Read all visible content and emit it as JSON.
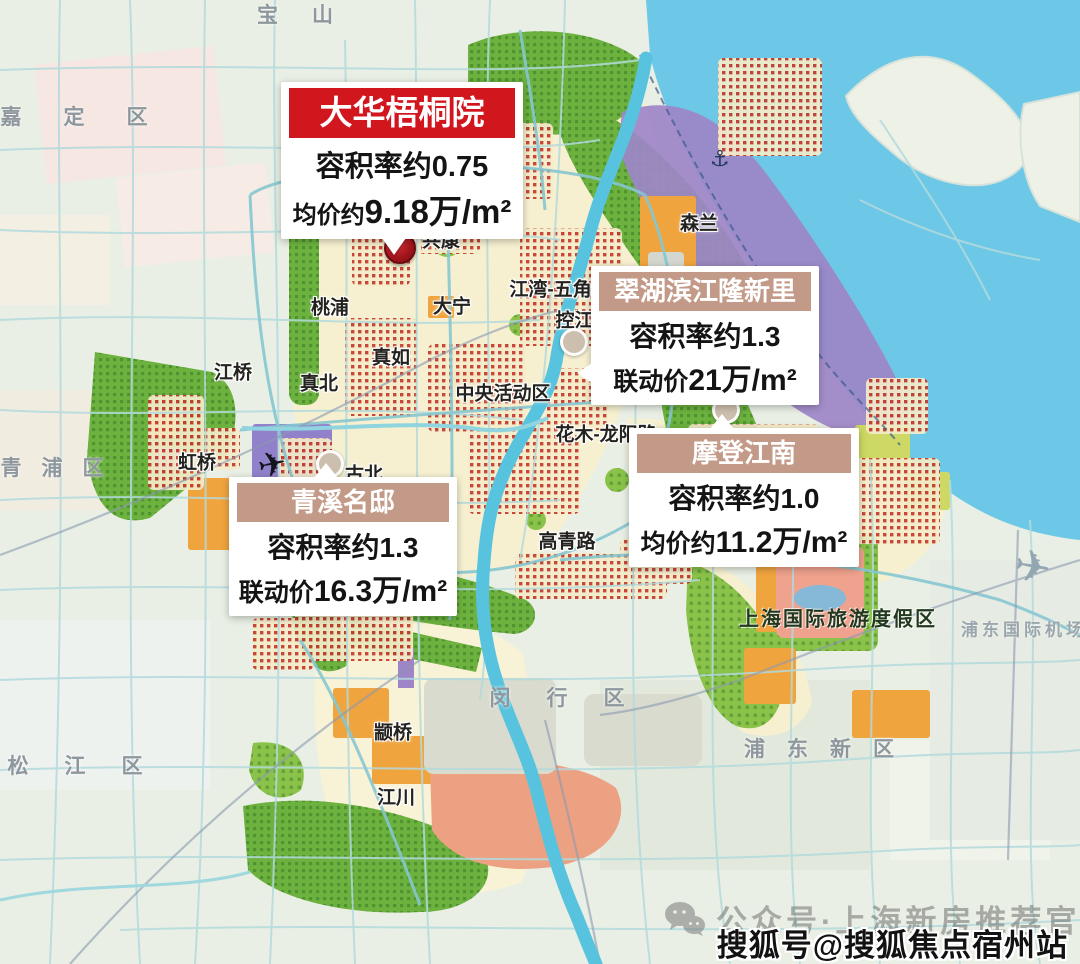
{
  "callouts": [
    {
      "name": "大华梧桐院",
      "line1": "容积率约0.75",
      "line2_label": "均价约",
      "line2_value": "9.18万/m²"
    },
    {
      "name": "翠湖滨江隆新里",
      "line1": "容积率约1.3",
      "line2_label": "联动价",
      "line2_value": "21万/m²"
    },
    {
      "name": "摩登江南",
      "line1": "容积率约1.0",
      "line2_label": "均价约",
      "line2_value": "11.2万/m²"
    },
    {
      "name": "青溪名邸",
      "line1": "容积率约1.3",
      "line2_label": "联动价",
      "line2_value": "16.3万/m²"
    }
  ],
  "watermarks": {
    "wechat": "公众号·上海新房推荐官",
    "sohu": "搜狐号@搜狐焦点宿州站"
  },
  "map_labels": {
    "districts": [
      {
        "text": "宝山",
        "x": 312,
        "y": 14,
        "ls": 34
      },
      {
        "text": "嘉定区",
        "x": 95,
        "y": 116,
        "ls": 42
      },
      {
        "text": "青浦区",
        "x": 62,
        "y": 467,
        "ls": 20
      },
      {
        "text": "松江区",
        "x": 93,
        "y": 765,
        "ls": 36
      },
      {
        "text": "闵行区",
        "x": 575,
        "y": 697,
        "ls": 36
      },
      {
        "text": "浦东新区",
        "x": 830,
        "y": 748,
        "ls": 22
      }
    ],
    "places": [
      {
        "text": "共康",
        "x": 441,
        "y": 239
      },
      {
        "text": "桃浦",
        "x": 330,
        "y": 306
      },
      {
        "text": "大宁",
        "x": 452,
        "y": 305
      },
      {
        "text": "江湾-五角场",
        "x": 560,
        "y": 288
      },
      {
        "text": "控江路",
        "x": 584,
        "y": 319
      },
      {
        "text": "真如",
        "x": 391,
        "y": 356
      },
      {
        "text": "真北",
        "x": 319,
        "y": 382
      },
      {
        "text": "江桥",
        "x": 233,
        "y": 371
      },
      {
        "text": "虹桥",
        "x": 197,
        "y": 461
      },
      {
        "text": "古北",
        "x": 364,
        "y": 473
      },
      {
        "text": "中央活动区",
        "x": 503,
        "y": 392
      },
      {
        "text": "花木-龙阳路",
        "x": 606,
        "y": 433
      },
      {
        "text": "高青路",
        "x": 567,
        "y": 540
      },
      {
        "text": "御桥",
        "x": 658,
        "y": 551
      },
      {
        "text": "莘庄",
        "x": 336,
        "y": 605
      },
      {
        "text": "颛桥",
        "x": 393,
        "y": 731
      },
      {
        "text": "江川",
        "x": 396,
        "y": 796
      },
      {
        "text": "森兰",
        "x": 699,
        "y": 222
      },
      {
        "text": "沙",
        "x": 833,
        "y": 502
      }
    ],
    "areas": [
      {
        "text": "上海国际旅游度假区",
        "x": 838,
        "y": 617,
        "tone": "dark"
      },
      {
        "text": "浦东国际机场",
        "x": 1024,
        "y": 628,
        "tone": "light"
      }
    ]
  },
  "colors": {
    "accent_red": "#d2161e",
    "header_tan": "#c39a88",
    "water": "#6cc8e6",
    "green": "#6db23f",
    "purple": "#9d85c8",
    "orange": "#f0a43e",
    "salmon": "#efa28d",
    "red_dots": "#c43a2c"
  }
}
